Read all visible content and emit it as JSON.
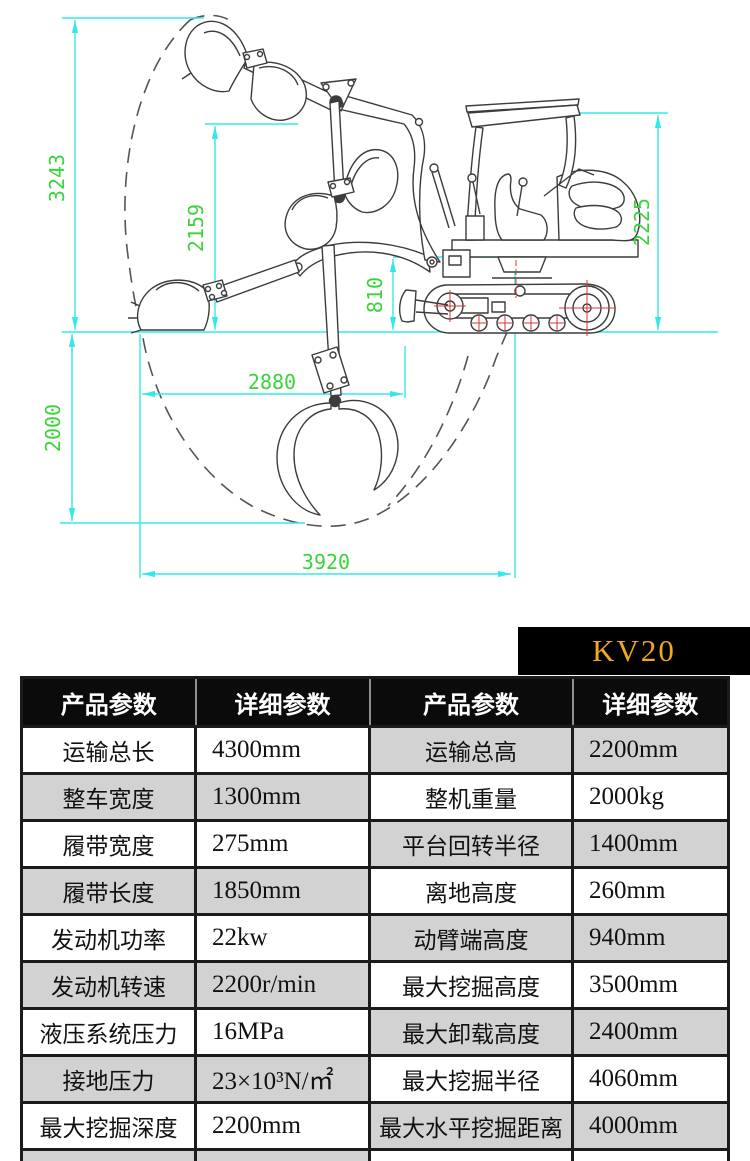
{
  "banner": {
    "model": "KV20"
  },
  "diagram": {
    "dims": {
      "left_total_height": "3243",
      "mid_height": "2159",
      "boom_base_height": "810",
      "machine_height": "2225",
      "mid_reach": "2880",
      "dig_depth": "2000",
      "ground_reach": "3920"
    }
  },
  "table": {
    "headers": [
      "产品参数",
      "详细参数",
      "产品参数",
      "详细参数"
    ],
    "rows": [
      [
        "运输总长",
        "4300mm",
        "运输总高",
        "2200mm"
      ],
      [
        "整车宽度",
        "1300mm",
        "整机重量",
        "2000kg"
      ],
      [
        "履带宽度",
        "275mm",
        "平台回转半径",
        "1400mm"
      ],
      [
        "履带长度",
        "1850mm",
        "离地高度",
        "260mm"
      ],
      [
        "发动机功率",
        "22kw",
        "动臂端高度",
        "940mm"
      ],
      [
        "发动机转速",
        "2200r/min",
        "最大挖掘高度",
        "3500mm"
      ],
      [
        "液压系统压力",
        "16MPa",
        "最大卸载高度",
        "2400mm"
      ],
      [
        "接地压力",
        "23×10³N/㎡",
        "最大挖掘半径",
        "4060mm"
      ],
      [
        "最大挖掘深度",
        "2200mm",
        "最大水平挖掘距离",
        "4000mm"
      ],
      [
        "最小回转半径",
        "1900mm",
        "最大挖掘高度半径",
        "3100mm"
      ]
    ]
  },
  "colors": {
    "dimension_line": "#35e8e8",
    "dimension_text": "#3bd33b",
    "banner_bg": "#000000",
    "banner_text": "#f2a71f",
    "header_bg": "#0b0b0b",
    "cell_gray": "#d2d2d2",
    "drawing_line": "#3c3c3c",
    "hub_red": "#d83434"
  }
}
